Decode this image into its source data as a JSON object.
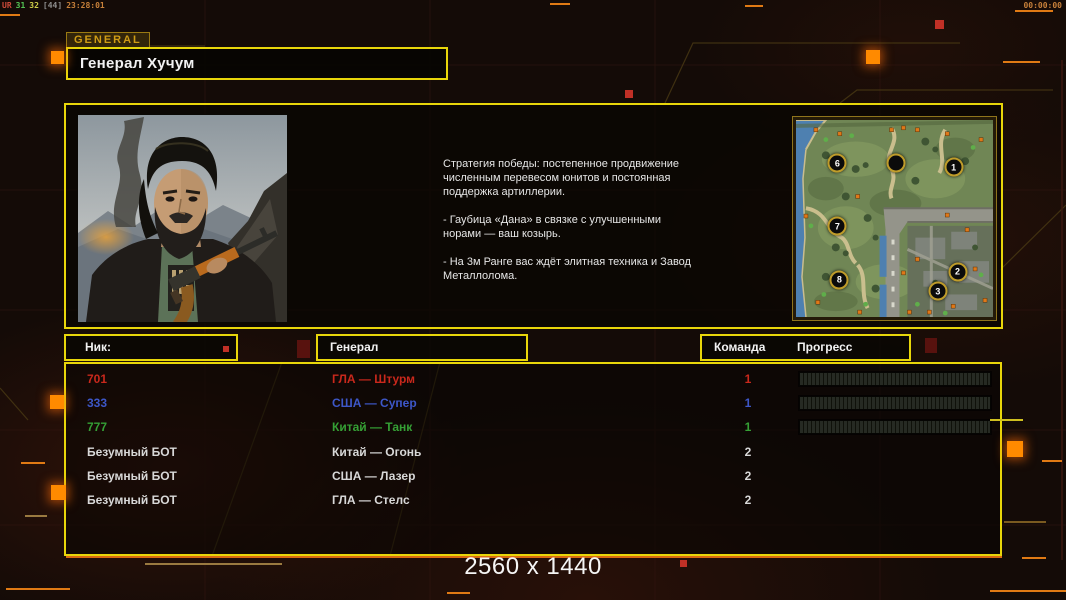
{
  "overlay": {
    "stats": [
      {
        "text": "UR",
        "color": "#cf4b3a"
      },
      {
        "text": "31",
        "color": "#54c454"
      },
      {
        "text": "32",
        "color": "#cfcf4a"
      },
      {
        "text": "[44]",
        "color": "#8f8f8f"
      },
      {
        "text": "23:28:01",
        "color": "#c8813a"
      }
    ],
    "timer": "00:00:00"
  },
  "header": {
    "tab": "GENERAL",
    "title": "Генерал Хучум"
  },
  "briefing": {
    "paragraphs": [
      "Стратегия победы: постепенное продвижение численным перевесом юнитов и постоянная поддержка артиллерии.",
      "- Гаубица «Дана» в связке с улучшенными норами — ваш козырь.",
      "- На 3м Ранге вас ждёт элитная техника и Завод Металлолома."
    ]
  },
  "minimap": {
    "markers": [
      {
        "label": "6",
        "x": 21,
        "y": 22
      },
      {
        "label": "",
        "x": 51,
        "y": 22
      },
      {
        "label": "1",
        "x": 80,
        "y": 24
      },
      {
        "label": "7",
        "x": 21,
        "y": 54
      },
      {
        "label": "8",
        "x": 22,
        "y": 81
      },
      {
        "label": "2",
        "x": 82,
        "y": 77
      },
      {
        "label": "3",
        "x": 72,
        "y": 87
      }
    ]
  },
  "table": {
    "headers": {
      "nick": "Ник:",
      "general": "Генерал",
      "team": "Команда",
      "progress": "Прогресс"
    },
    "rows": [
      {
        "nick": "701",
        "general": "ГЛА — Штурм",
        "team": "1",
        "color": "#c9281c",
        "has_progress": true
      },
      {
        "nick": "333",
        "general": "США — Супер",
        "team": "1",
        "color": "#3d57c8",
        "has_progress": true
      },
      {
        "nick": "777",
        "general": "Китай — Танк",
        "team": "1",
        "color": "#35a035",
        "has_progress": true
      },
      {
        "nick": "Безумный БОТ",
        "general": "Китай — Огонь",
        "team": "2",
        "color": "#d8d8d8",
        "has_progress": false
      },
      {
        "nick": "Безумный БОТ",
        "general": "США — Лазер",
        "team": "2",
        "color": "#d8d8d8",
        "has_progress": false
      },
      {
        "nick": "Безумный БОТ",
        "general": "ГЛА — Стелс",
        "team": "2",
        "color": "#d8d8d8",
        "has_progress": false
      }
    ]
  },
  "footer": {
    "resolution": "2560 x 1440"
  },
  "colors": {
    "frame_yellow": "#e8d60a",
    "accent_orange": "#ff8a00",
    "line_orange": "#d96a12",
    "player_red": "#c9281c",
    "player_blue": "#3d57c8",
    "player_green": "#35a035",
    "bot_white": "#d8d8d8"
  }
}
